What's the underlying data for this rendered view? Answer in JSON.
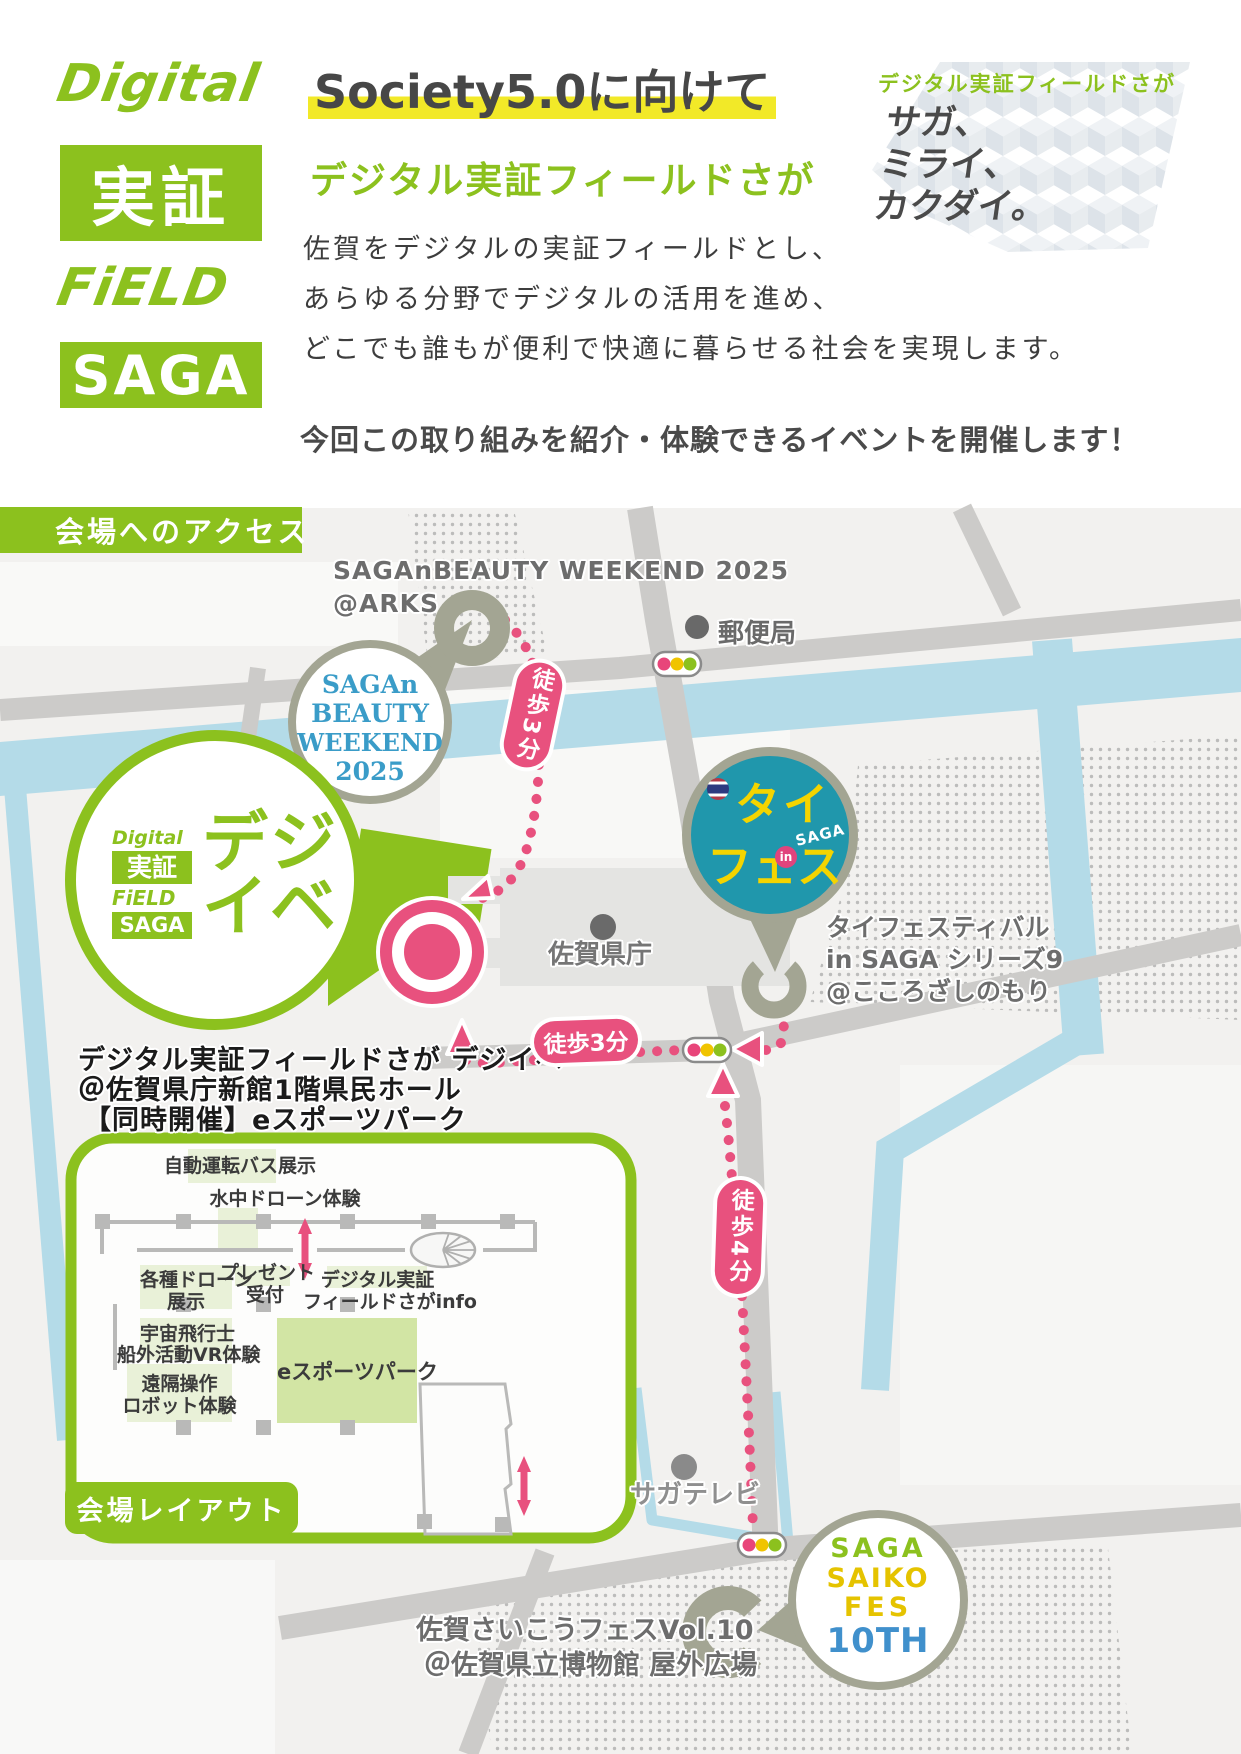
{
  "header": {
    "logo": {
      "line1": "Digital",
      "line2": "実証",
      "line3": "FiELD",
      "line4": "SAGA"
    },
    "headline": "Society5.0に向けて",
    "subheadline": "デジタル実証フィールドさが",
    "body_line1": "佐賀をデジタルの実証フィールドとし、",
    "body_line2": "あらゆる分野でデジタルの活用を進め、",
    "body_line3": "どこでも誰もが便利で快適に暮らせる社会を実現します。",
    "cta": "今回この取り組みを紹介・体験できるイベントを開催します！",
    "sidenote": {
      "title": "デジタル実証フィールドさが",
      "line1": "サガ、",
      "line2": "ミライ、",
      "line3": "カクダイ。"
    }
  },
  "map": {
    "access_banner": "会場へのアクセス",
    "beauty": {
      "label1": "SAGAnBEAUTY WEEKEND 2025",
      "label2": "@ARKS",
      "badge1": "SAGAn",
      "badge2": "BEAUTY",
      "badge3": "WEEKEND",
      "badge4": "2025"
    },
    "post_office": "郵便局",
    "thaifes": {
      "badge_line1": "タイ",
      "badge_line2": "フェス",
      "badge_in": "in",
      "badge_saga": "SAGA",
      "label1": "タイフェスティバル",
      "label2": "in SAGA シリーズ9",
      "label3": "@こころざしのもり"
    },
    "dejiibe": {
      "mini_logo1": "Digital",
      "mini_logo2": "実証",
      "mini_logo3": "FiELD",
      "mini_logo4": "SAGA",
      "name_line1": "デジ",
      "name_line2": "イベ",
      "label1": "デジタル実証フィールドさが デジイベ",
      "label2": "＠佐賀県庁新館1階県民ホール",
      "label3": "【同時開催】eスポーツパーク"
    },
    "prefecture_office": "佐賀県庁",
    "saga_tv": "サガテレビ",
    "walk_pill_1": "徒歩3分",
    "walk_pill_2": "徒歩3分",
    "walk_pill_3": "徒歩4分",
    "saiko": {
      "badge1": "SAGA",
      "badge2": "SAIKO",
      "badge3": "FES",
      "badge4": "10TH",
      "label1": "佐賀さいこうフェスVol.10",
      "label2": "＠佐賀県立博物館 屋外広場"
    }
  },
  "inset": {
    "banner": "会場レイアウト",
    "room_bus": "自動運転バス展示",
    "room_underwater_drone": "水中ドローン体験",
    "room_drones_line1": "各種ドローン",
    "room_drones_line2": "展示",
    "room_present_line1": "プレゼント",
    "room_present_line2": "受付",
    "room_info_line1": "デジタル実証",
    "room_info_line2": "フィールドさがinfo",
    "room_vr_line1": "宇宙飛行士",
    "room_vr_line2": "船外活動VR体験",
    "room_robot_line1": "遠隔操作",
    "room_robot_line2": "ロボット体験",
    "room_esports": "eスポーツパーク"
  },
  "colors": {
    "green": "#8cc11e",
    "pink": "#e8517e",
    "sage": "#a3a593",
    "teal": "#2097ac",
    "highlight_yellow": "#f2e928",
    "water": "#b4dbe8",
    "beauty_blue": "#3a9cc8"
  }
}
